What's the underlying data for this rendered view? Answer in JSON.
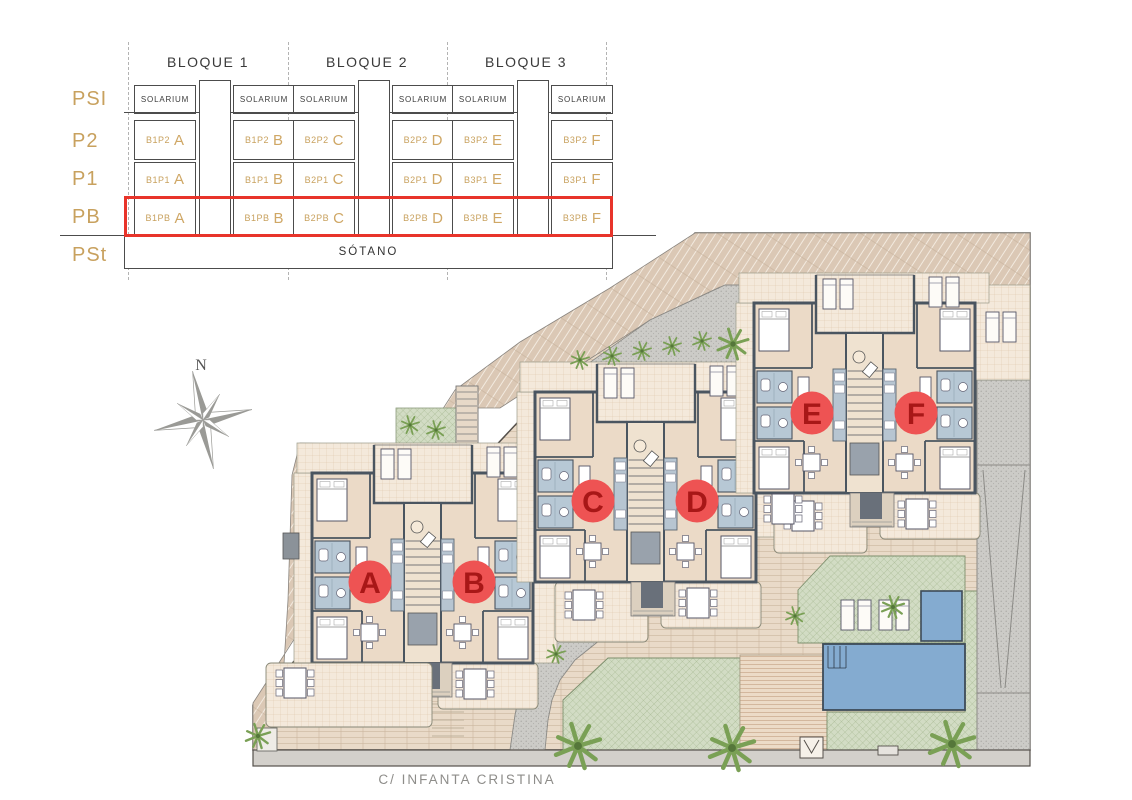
{
  "legend": {
    "block_headers": [
      "BLOQUE 1",
      "BLOQUE 2",
      "BLOQUE 3"
    ],
    "solarium_label": "SOLARIUM",
    "basement_label": "SÓTANO",
    "highlighted_floor": "PB",
    "floors": [
      {
        "label": "PSI"
      },
      {
        "label": "P2",
        "cells": [
          {
            "code": "B1P2",
            "letter": "A"
          },
          {
            "code": "B1P2",
            "letter": "B"
          },
          {
            "code": "B2P2",
            "letter": "C"
          },
          {
            "code": "B2P2",
            "letter": "D"
          },
          {
            "code": "B3P2",
            "letter": "E"
          },
          {
            "code": "B3P2",
            "letter": "F"
          }
        ]
      },
      {
        "label": "P1",
        "cells": [
          {
            "code": "B1P1",
            "letter": "A"
          },
          {
            "code": "B1P1",
            "letter": "B"
          },
          {
            "code": "B2P1",
            "letter": "C"
          },
          {
            "code": "B2P1",
            "letter": "D"
          },
          {
            "code": "B3P1",
            "letter": "E"
          },
          {
            "code": "B3P1",
            "letter": "F"
          }
        ]
      },
      {
        "label": "PB",
        "highlighted": true,
        "cells": [
          {
            "code": "B1PB",
            "letter": "A"
          },
          {
            "code": "B1PB",
            "letter": "B"
          },
          {
            "code": "B2PB",
            "letter": "C"
          },
          {
            "code": "B2PB",
            "letter": "D"
          },
          {
            "code": "B3PB",
            "letter": "E"
          },
          {
            "code": "B3PB",
            "letter": "F"
          }
        ]
      },
      {
        "label": "PSt"
      }
    ]
  },
  "compass": {
    "north_label": "N"
  },
  "site": {
    "street_label": "C/ INFANTA CRISTINA",
    "units": [
      {
        "letter": "A"
      },
      {
        "letter": "B"
      },
      {
        "letter": "C"
      },
      {
        "letter": "D"
      },
      {
        "letter": "E"
      },
      {
        "letter": "F"
      }
    ]
  },
  "colors": {
    "highlight_red": "#e8342a",
    "unit_marker_fill": "#ee5353",
    "unit_marker_letter": "#a81717",
    "legend_gold": "#c8a15e",
    "wall": "#4a5560",
    "pool_blue": "#84abd0",
    "terrain_beige": "#dbc8b5",
    "lawn_green": "#d2dcc4",
    "path_gray": "#cccbc7"
  }
}
